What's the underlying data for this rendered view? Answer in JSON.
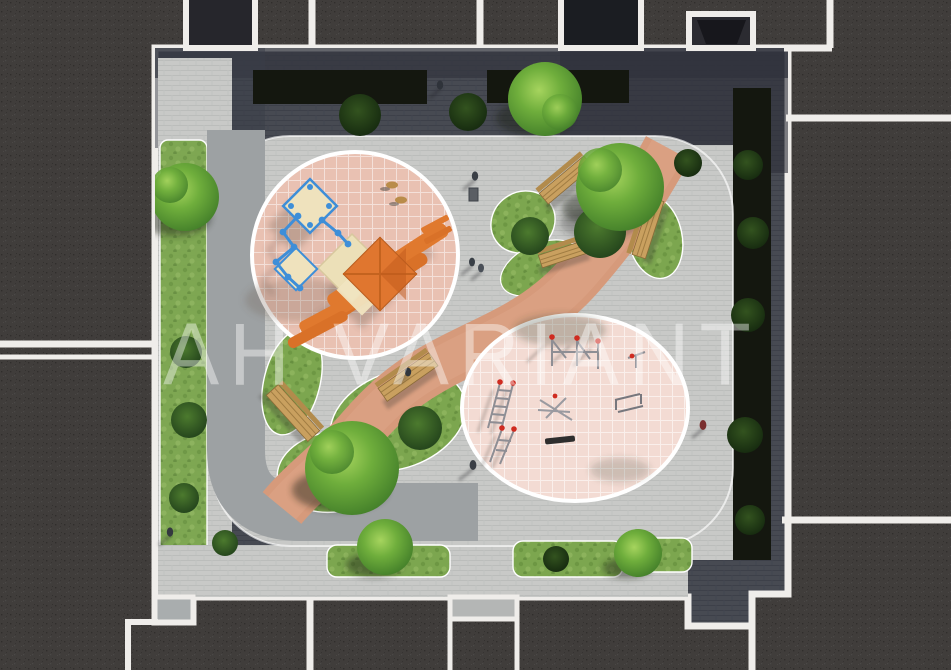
{
  "watermark": {
    "text": "АН VARIANT"
  },
  "palette": {
    "roof": "#403d3b",
    "outline_white": "#efedea",
    "courtyard_slate": "#474a52",
    "plaza_light": "#c8c9c7",
    "path_gray": "#9da1a3",
    "path_salmon": "#d69a7b",
    "playground_pink": "#e9c1b2",
    "fitness_pink": "#f3dbd3",
    "grass_green": "#7ca64f",
    "planting_dark": "#14170f",
    "equipment_orange": "#e0792e",
    "equipment_blue": "#3e8ed8",
    "platform_cream": "#efe2bd",
    "bench_wood": "#c9a05f",
    "accent_red": "#cf2b20"
  }
}
